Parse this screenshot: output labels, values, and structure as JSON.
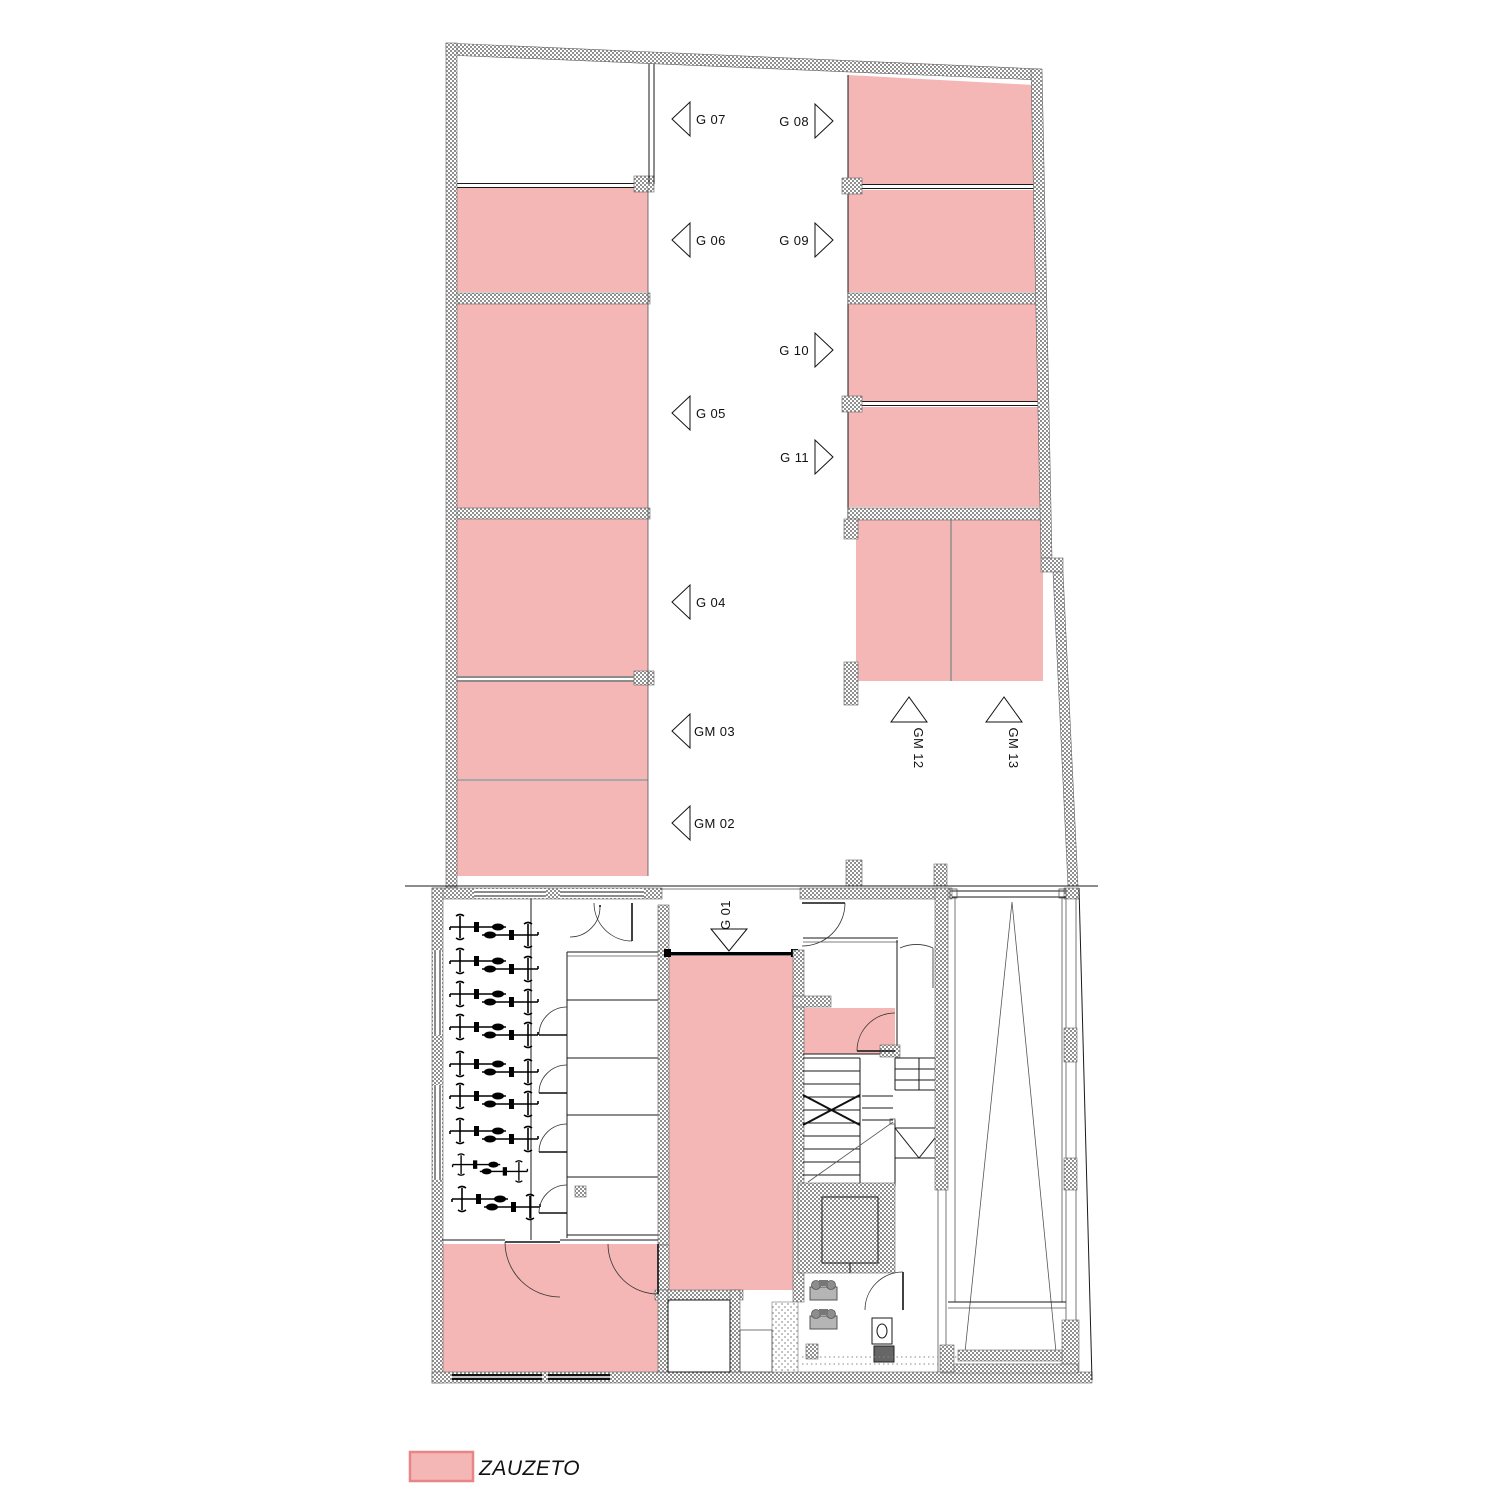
{
  "plan": {
    "type": "garage-floor-plan",
    "legend": {
      "label": "ZAUZETO"
    },
    "colors": {
      "occupied": "#f5b6b6",
      "legend_border": "#e88585",
      "wall_hatch": "#909090"
    },
    "parking": {
      "spots": [
        {
          "id": "G 01",
          "occupied": true
        },
        {
          "id": "GM 02",
          "occupied": true
        },
        {
          "id": "GM 03",
          "occupied": true
        },
        {
          "id": "G 04",
          "occupied": true
        },
        {
          "id": "G 05",
          "occupied": true
        },
        {
          "id": "G 06",
          "occupied": true
        },
        {
          "id": "G 07",
          "occupied": false
        },
        {
          "id": "G 08",
          "occupied": true
        },
        {
          "id": "G 09",
          "occupied": true
        },
        {
          "id": "G 10",
          "occupied": true
        },
        {
          "id": "G 11",
          "occupied": true
        },
        {
          "id": "GM 12",
          "occupied": true
        },
        {
          "id": "GM 13",
          "occupied": true
        }
      ]
    }
  }
}
